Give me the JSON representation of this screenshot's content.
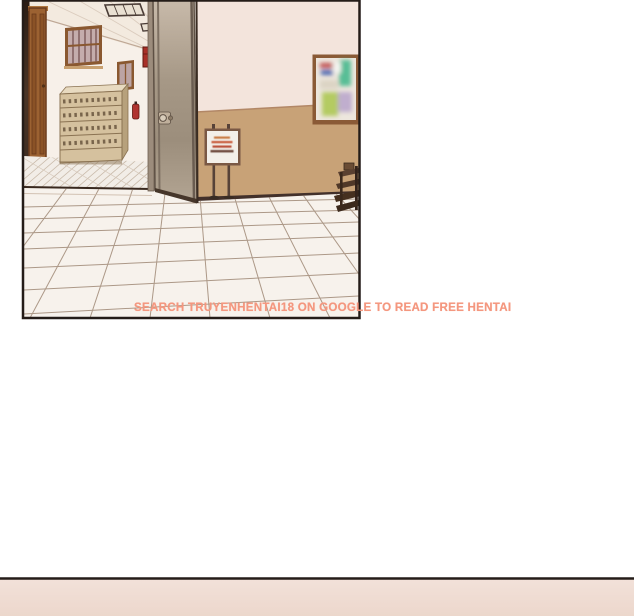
{
  "watermark": {
    "text": "SEARCH TRUYENHENTAI18 ON GOOGLE TO READ FREE HENTAI",
    "color": "#f4977f"
  },
  "panels": {
    "top_border_color": "#241c18",
    "bottom_fill": "#f0ded6"
  },
  "palette": {
    "page_bg": "#ffffff",
    "inner_wall": "#f7f0e9",
    "right_wall_upper": "#f3e4dc",
    "right_wall_lower": "#c8a277",
    "baseboard": "#42302a",
    "wooden_door": "#9c6232",
    "glass_door": "#a29482",
    "floor": "#f7f2ec",
    "floor_grout": "#ac9887",
    "fire_cabinet_red": "#a83028"
  }
}
